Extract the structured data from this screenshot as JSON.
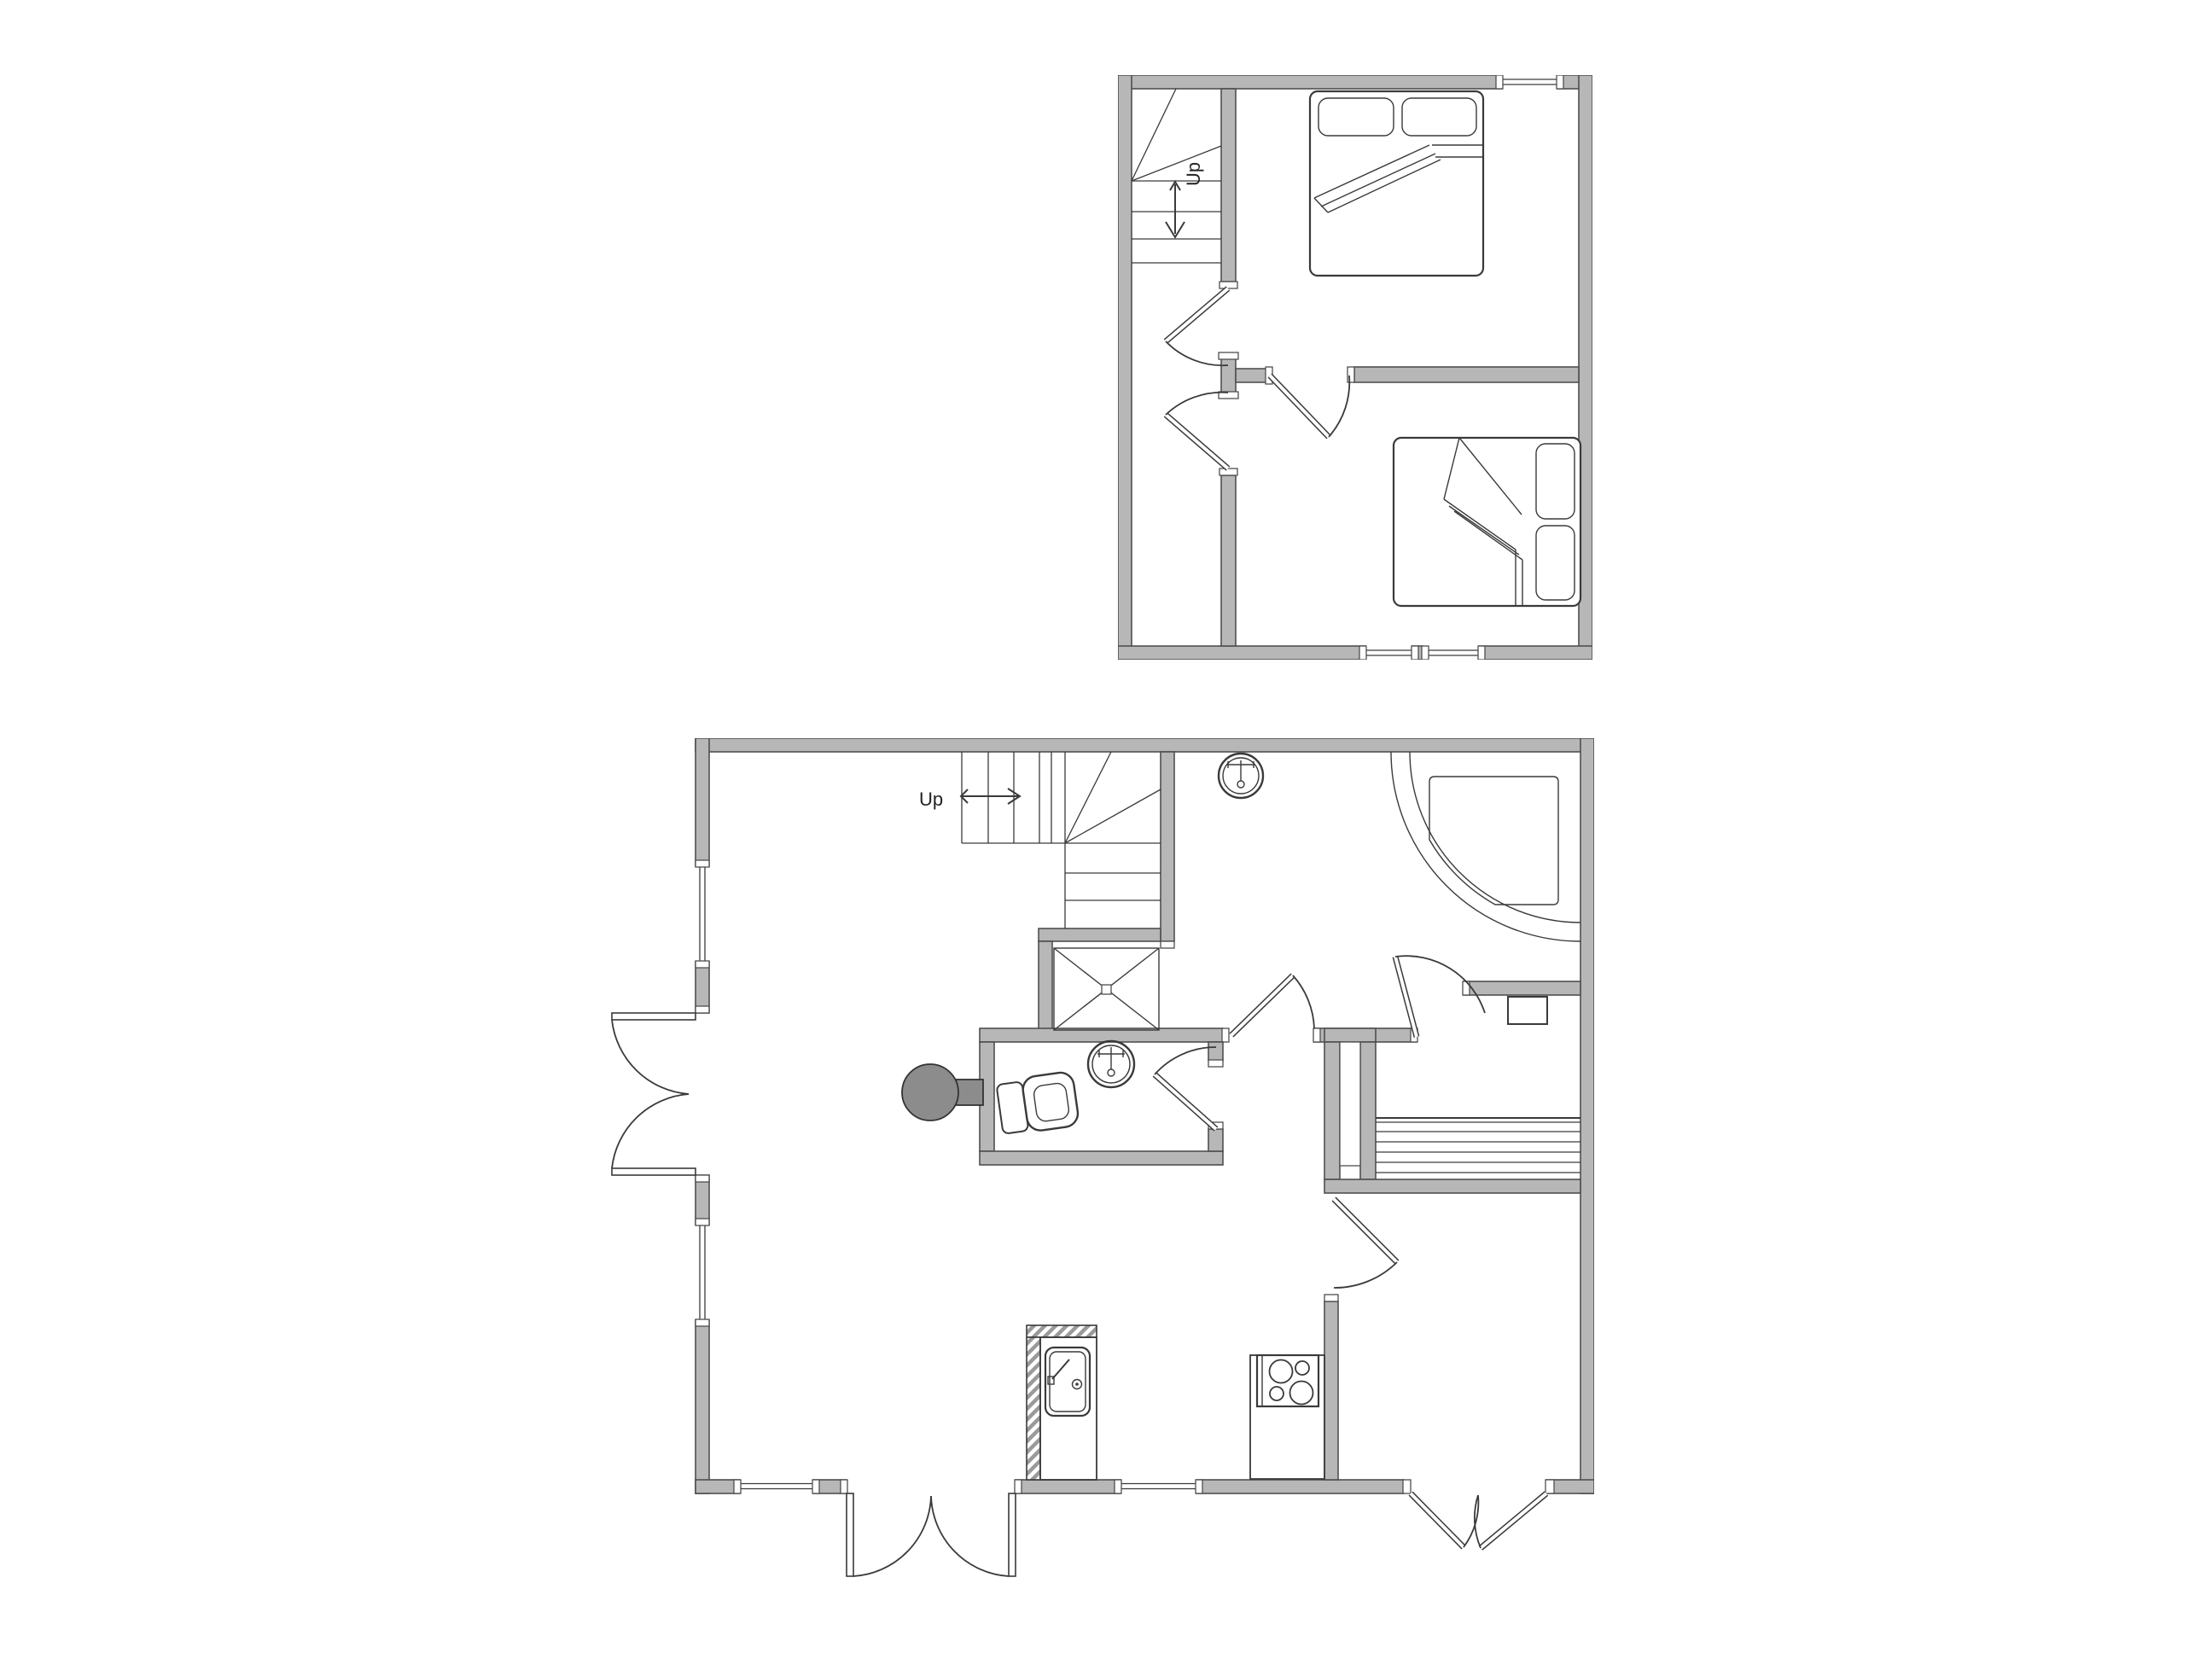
{
  "title": "Two-storey house floor plan",
  "colors": {
    "background": "#ffffff",
    "wall_fill": "#b7b7b7",
    "wall_stroke": "#4f4f4f",
    "line": "#3a3a3a",
    "fixture_dark": "#8c8c8c"
  },
  "upper_floor": {
    "name": "upper floor plan",
    "stairs": {
      "label": "Up",
      "direction": "down-arrow"
    },
    "rooms": [
      "stairwell",
      "bedroom-1",
      "bedroom-2",
      "landing"
    ],
    "fixtures": [
      "staircase-winder",
      "double-bed-with-two-pillows",
      "double-bed-with-two-pillows"
    ],
    "doors": [
      "stairwell-door",
      "bedroom-2-door",
      "landing-door"
    ],
    "windows": [
      "top-wall-window",
      "bottom-wall-window-left",
      "bottom-wall-window-right"
    ]
  },
  "lower_floor": {
    "name": "ground floor plan",
    "stairs": {
      "label": "Up",
      "direction": "right-arrow"
    },
    "rooms": [
      "living-room",
      "hall",
      "bathroom",
      "washroom",
      "sauna",
      "kitchen",
      "dining-room"
    ],
    "fixtures": [
      "staircase-winder",
      "shower-cabin",
      "corner-shower",
      "round-washbasin",
      "round-washbasin",
      "toilet",
      "water-heater",
      "sauna-benches",
      "sauna-heater",
      "kitchen-sink",
      "cooktop-4-burners"
    ],
    "doors": [
      "french-door-left",
      "french-door-bottom",
      "double-door-bottom-right",
      "bathroom-door",
      "washroom-door",
      "sauna-door",
      "dining-door"
    ],
    "windows": [
      "left-wall-window-upper",
      "left-wall-window-lower",
      "bottom-wall-window-left",
      "kitchen-window"
    ]
  }
}
